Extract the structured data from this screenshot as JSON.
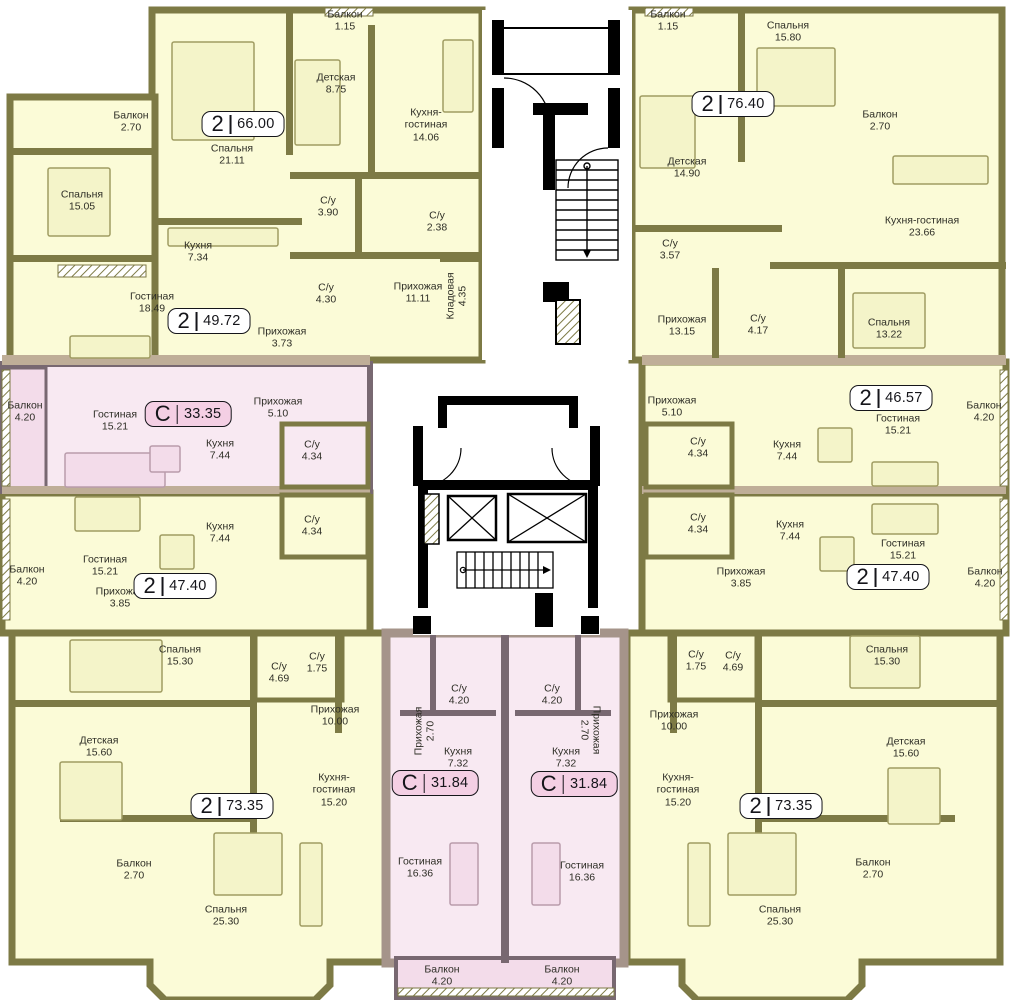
{
  "plan_title": "Residential floor plan",
  "colors": {
    "apartment_fill": "#fbfbd7",
    "apartment_furniture": "#f4f4c9",
    "wall_olive": "#7d7a45",
    "studio_fill": "#f8e9f2",
    "studio_balcony_fill": "#f3dcea",
    "studio_wall": "#786871",
    "studio_outer_wall": "#a5948a",
    "slab_band": "#bfae98",
    "core_wall": "#000000",
    "badge_2room_fill": "#ffffff",
    "badge_studio_fill": "#f4cfe4",
    "label_text": "#2e2e26"
  },
  "badges": [
    {
      "type": "2",
      "area": "66.00",
      "x": 243,
      "y": 124,
      "studio": false
    },
    {
      "type": "2",
      "area": "76.40",
      "x": 733,
      "y": 104,
      "studio": false
    },
    {
      "type": "2",
      "area": "49.72",
      "x": 209,
      "y": 321,
      "studio": false
    },
    {
      "type": "С",
      "area": "33.35",
      "x": 188,
      "y": 414,
      "studio": true
    },
    {
      "type": "2",
      "area": "46.57",
      "x": 891,
      "y": 398,
      "studio": false
    },
    {
      "type": "2",
      "area": "47.40",
      "x": 175,
      "y": 586,
      "studio": false
    },
    {
      "type": "2",
      "area": "47.40",
      "x": 888,
      "y": 577,
      "studio": false
    },
    {
      "type": "С",
      "area": "31.84",
      "x": 435,
      "y": 783,
      "studio": true
    },
    {
      "type": "С",
      "area": "31.84",
      "x": 574,
      "y": 784,
      "studio": true
    },
    {
      "type": "2",
      "area": "73.35",
      "x": 232,
      "y": 806,
      "studio": false
    },
    {
      "type": "2",
      "area": "73.35",
      "x": 781,
      "y": 806,
      "studio": false
    }
  ],
  "rooms": [
    {
      "name": "Балкон",
      "area": "2.70",
      "x": 131,
      "y": 122
    },
    {
      "name": "Спальня",
      "area": "15.05",
      "x": 82,
      "y": 201
    },
    {
      "name": "Спальня",
      "area": "21.11",
      "x": 232,
      "y": 155
    },
    {
      "name": "Кухня",
      "area": "7.34",
      "x": 198,
      "y": 252
    },
    {
      "name": "Гостиная",
      "area": "18.49",
      "x": 152,
      "y": 303
    },
    {
      "name": "Прихожая",
      "area": "3.73",
      "x": 282,
      "y": 338
    },
    {
      "name": "С/у",
      "area": "3.90",
      "x": 328,
      "y": 207
    },
    {
      "name": "С/у",
      "area": "4.30",
      "x": 326,
      "y": 294
    },
    {
      "name": "С/у",
      "area": "2.38",
      "x": 437,
      "y": 222
    },
    {
      "name": "Прихожая",
      "area": "11.11",
      "x": 418,
      "y": 293
    },
    {
      "name": "Кладовая",
      "area": "4.35",
      "x": 457,
      "y": 296,
      "rot": "vneg"
    },
    {
      "name": "Детская",
      "area": "8.75",
      "x": 336,
      "y": 84
    },
    {
      "name": "Балкон",
      "area": "1.15",
      "x": 345,
      "y": 21
    },
    {
      "name": "Кухня-гостиная",
      "area": "14.06",
      "x": 426,
      "y": 125,
      "w": 64
    },
    {
      "name": "Балкон",
      "area": "4.20",
      "x": 25,
      "y": 412
    },
    {
      "name": "Гостиная",
      "area": "15.21",
      "x": 115,
      "y": 421
    },
    {
      "name": "Прихожая",
      "area": "5.10",
      "x": 278,
      "y": 408
    },
    {
      "name": "Кухня",
      "area": "7.44",
      "x": 220,
      "y": 450
    },
    {
      "name": "С/у",
      "area": "4.34",
      "x": 312,
      "y": 451
    },
    {
      "name": "Балкон",
      "area": "4.20",
      "x": 27,
      "y": 576
    },
    {
      "name": "Гостиная",
      "area": "15.21",
      "x": 105,
      "y": 566
    },
    {
      "name": "Кухня",
      "area": "7.44",
      "x": 220,
      "y": 533
    },
    {
      "name": "С/у",
      "area": "4.34",
      "x": 312,
      "y": 526
    },
    {
      "name": "Прихожая",
      "area": "3.85",
      "x": 120,
      "y": 598
    },
    {
      "name": "Спальня",
      "area": "15.30",
      "x": 180,
      "y": 656
    },
    {
      "name": "С/у",
      "area": "4.69",
      "x": 279,
      "y": 673
    },
    {
      "name": "С/у",
      "area": "1.75",
      "x": 317,
      "y": 663
    },
    {
      "name": "Прихожая",
      "area": "10.00",
      "x": 335,
      "y": 716
    },
    {
      "name": "Детская",
      "area": "15.60",
      "x": 99,
      "y": 747
    },
    {
      "name": "Балкон",
      "area": "2.70",
      "x": 134,
      "y": 870
    },
    {
      "name": "Кухня-гостиная",
      "area": "15.20",
      "x": 334,
      "y": 790,
      "w": 62
    },
    {
      "name": "Спальня",
      "area": "25.30",
      "x": 226,
      "y": 916
    },
    {
      "name": "С/у",
      "area": "4.20",
      "x": 459,
      "y": 695
    },
    {
      "name": "Прихожая",
      "area": "2.70",
      "x": 425,
      "y": 731,
      "rot": "vneg"
    },
    {
      "name": "Кухня",
      "area": "7.32",
      "x": 458,
      "y": 758
    },
    {
      "name": "Гостиная",
      "area": "16.36",
      "x": 420,
      "y": 868
    },
    {
      "name": "Балкон",
      "area": "4.20",
      "x": 442,
      "y": 976
    },
    {
      "name": "С/у",
      "area": "4.20",
      "x": 552,
      "y": 695
    },
    {
      "name": "Прихожая",
      "area": "2.70",
      "x": 590,
      "y": 730,
      "rot": "vpos"
    },
    {
      "name": "Кухня",
      "area": "7.32",
      "x": 566,
      "y": 758
    },
    {
      "name": "Гостиная",
      "area": "16.36",
      "x": 582,
      "y": 872
    },
    {
      "name": "Балкон",
      "area": "4.20",
      "x": 562,
      "y": 976
    },
    {
      "name": "Балкон",
      "area": "1.15",
      "x": 668,
      "y": 21
    },
    {
      "name": "Спальня",
      "area": "15.80",
      "x": 788,
      "y": 32
    },
    {
      "name": "Балкон",
      "area": "2.70",
      "x": 880,
      "y": 121
    },
    {
      "name": "Детская",
      "area": "14.90",
      "x": 687,
      "y": 168
    },
    {
      "name": "Кухня-гостиная",
      "area": "23.66",
      "x": 922,
      "y": 227,
      "w": 112
    },
    {
      "name": "С/у",
      "area": "3.57",
      "x": 670,
      "y": 250
    },
    {
      "name": "Прихожая",
      "area": "13.15",
      "x": 682,
      "y": 326
    },
    {
      "name": "С/у",
      "area": "4.17",
      "x": 758,
      "y": 325
    },
    {
      "name": "Спальня",
      "area": "13.22",
      "x": 889,
      "y": 329
    },
    {
      "name": "Прихожая",
      "area": "5.10",
      "x": 672,
      "y": 407
    },
    {
      "name": "Гостиная",
      "area": "15.21",
      "x": 898,
      "y": 425
    },
    {
      "name": "Балкон",
      "area": "4.20",
      "x": 984,
      "y": 412
    },
    {
      "name": "С/у",
      "area": "4.34",
      "x": 698,
      "y": 448
    },
    {
      "name": "Кухня",
      "area": "7.44",
      "x": 787,
      "y": 451
    },
    {
      "name": "С/у",
      "area": "4.34",
      "x": 698,
      "y": 524
    },
    {
      "name": "Кухня",
      "area": "7.44",
      "x": 790,
      "y": 531
    },
    {
      "name": "Гостиная",
      "area": "15.21",
      "x": 903,
      "y": 550
    },
    {
      "name": "Прихожая",
      "area": "3.85",
      "x": 741,
      "y": 578
    },
    {
      "name": "Балкон",
      "area": "4.20",
      "x": 985,
      "y": 578
    },
    {
      "name": "С/у",
      "area": "1.75",
      "x": 696,
      "y": 661
    },
    {
      "name": "С/у",
      "area": "4.69",
      "x": 733,
      "y": 662
    },
    {
      "name": "Прихожая",
      "area": "10.00",
      "x": 674,
      "y": 721
    },
    {
      "name": "Спальня",
      "area": "15.30",
      "x": 887,
      "y": 656
    },
    {
      "name": "Детская",
      "area": "15.60",
      "x": 906,
      "y": 748
    },
    {
      "name": "Кухня-гостиная",
      "area": "15.20",
      "x": 678,
      "y": 790,
      "w": 62
    },
    {
      "name": "Балкон",
      "area": "2.70",
      "x": 873,
      "y": 869
    },
    {
      "name": "Спальня",
      "area": "25.30",
      "x": 780,
      "y": 916
    }
  ]
}
